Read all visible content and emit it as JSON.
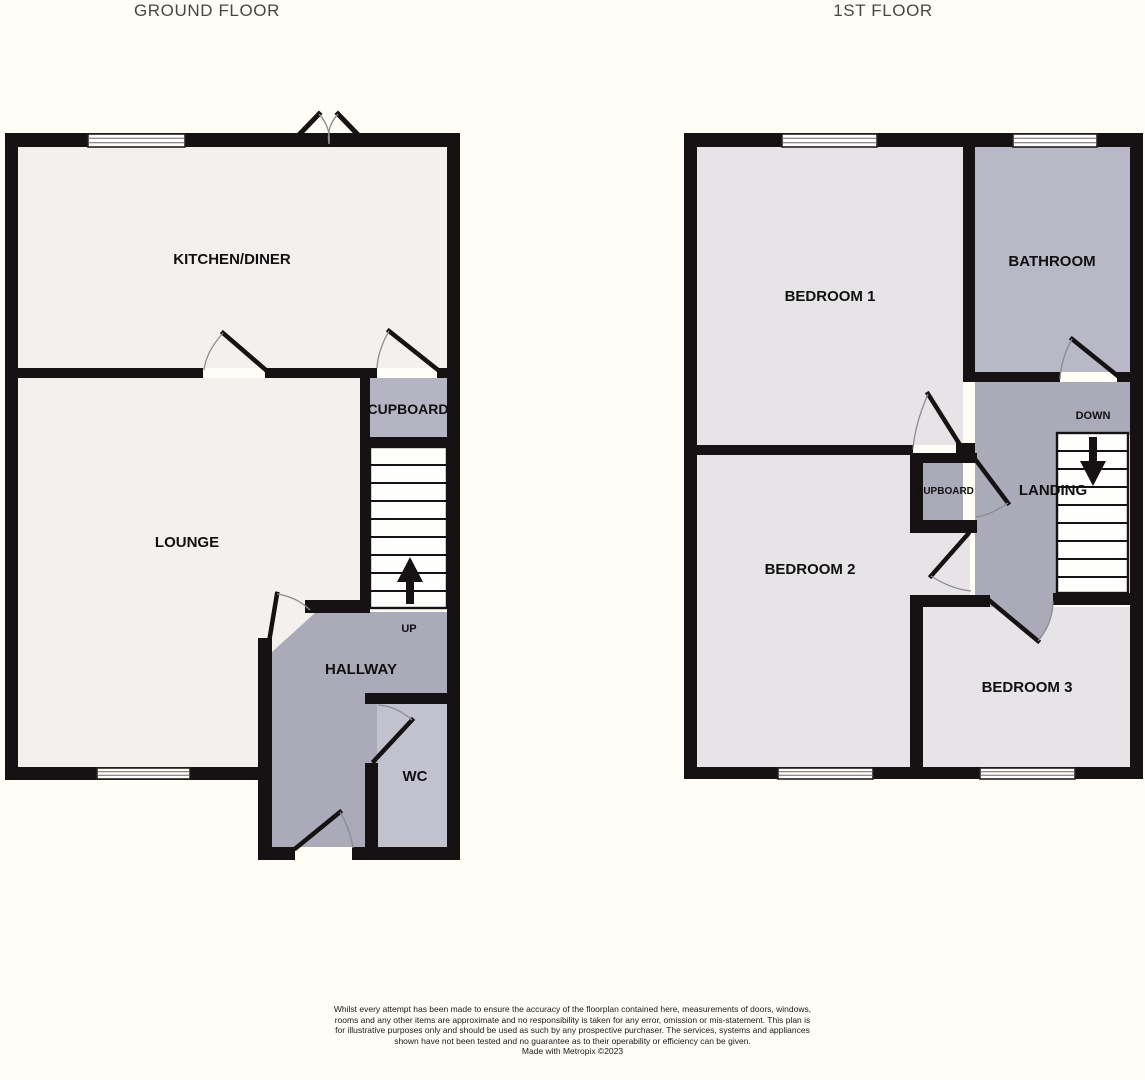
{
  "titles": {
    "ground_floor": "GROUND FLOOR",
    "first_floor": "1ST FLOOR"
  },
  "ground_floor": {
    "kitchen_diner": "KITCHEN/DINER",
    "lounge": "LOUNGE",
    "cupboard": "CUPBOARD",
    "hallway": "HALLWAY",
    "wc": "WC",
    "stairs_direction": "UP"
  },
  "first_floor": {
    "bedroom1": "BEDROOM 1",
    "bathroom": "BATHROOM",
    "bedroom2": "BEDROOM 2",
    "bedroom3": "BEDROOM 3",
    "cupboard": "CUPBOARD",
    "landing": "LANDING",
    "stairs_direction": "DOWN"
  },
  "colors": {
    "background": "#fffdf6",
    "wall": "#161213",
    "room_light": "#f3f0ee",
    "room_lavender": "#e7e4e8",
    "hall_gray": "#abaab8",
    "bathroom_gray": "#b9b8c7",
    "wc_gray": "#c2c1ce",
    "cupboard_gray": "#b5b4c2",
    "stair_white": "#fefefc"
  },
  "footer": {
    "disclaimer": "Whilst every attempt has been made to ensure the accuracy of the floorplan contained here, measurements of doors, windows, rooms and any other items are approximate and no responsibility is taken for any error, omission or mis-statement. This plan is for illustrative purposes only and should be used as such by any prospective purchaser. The services, systems and appliances shown have not been tested and no guarantee as to their operability or efficiency can be given.",
    "credit": "Made with Metropix ©2023"
  }
}
